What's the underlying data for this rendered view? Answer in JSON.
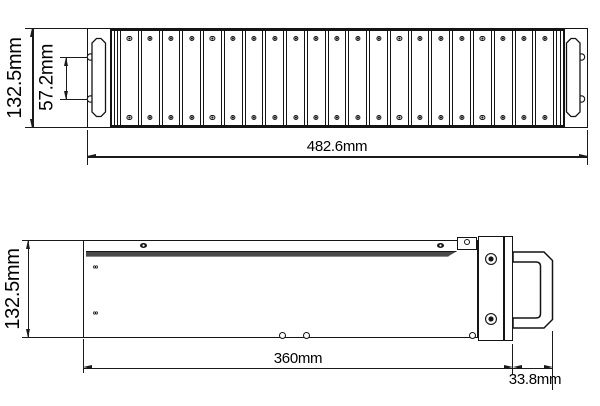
{
  "drawing": {
    "line_color": "#1a1a1a",
    "background": "#ffffff",
    "front_view": {
      "height_label": "132.5mm",
      "handle_pitch_label": "57.2mm",
      "width_label": "482.6mm",
      "fin_count": 21
    },
    "side_view": {
      "height_label": "132.5mm",
      "length_label": "360mm",
      "handle_depth_label": "33.8mm"
    }
  }
}
